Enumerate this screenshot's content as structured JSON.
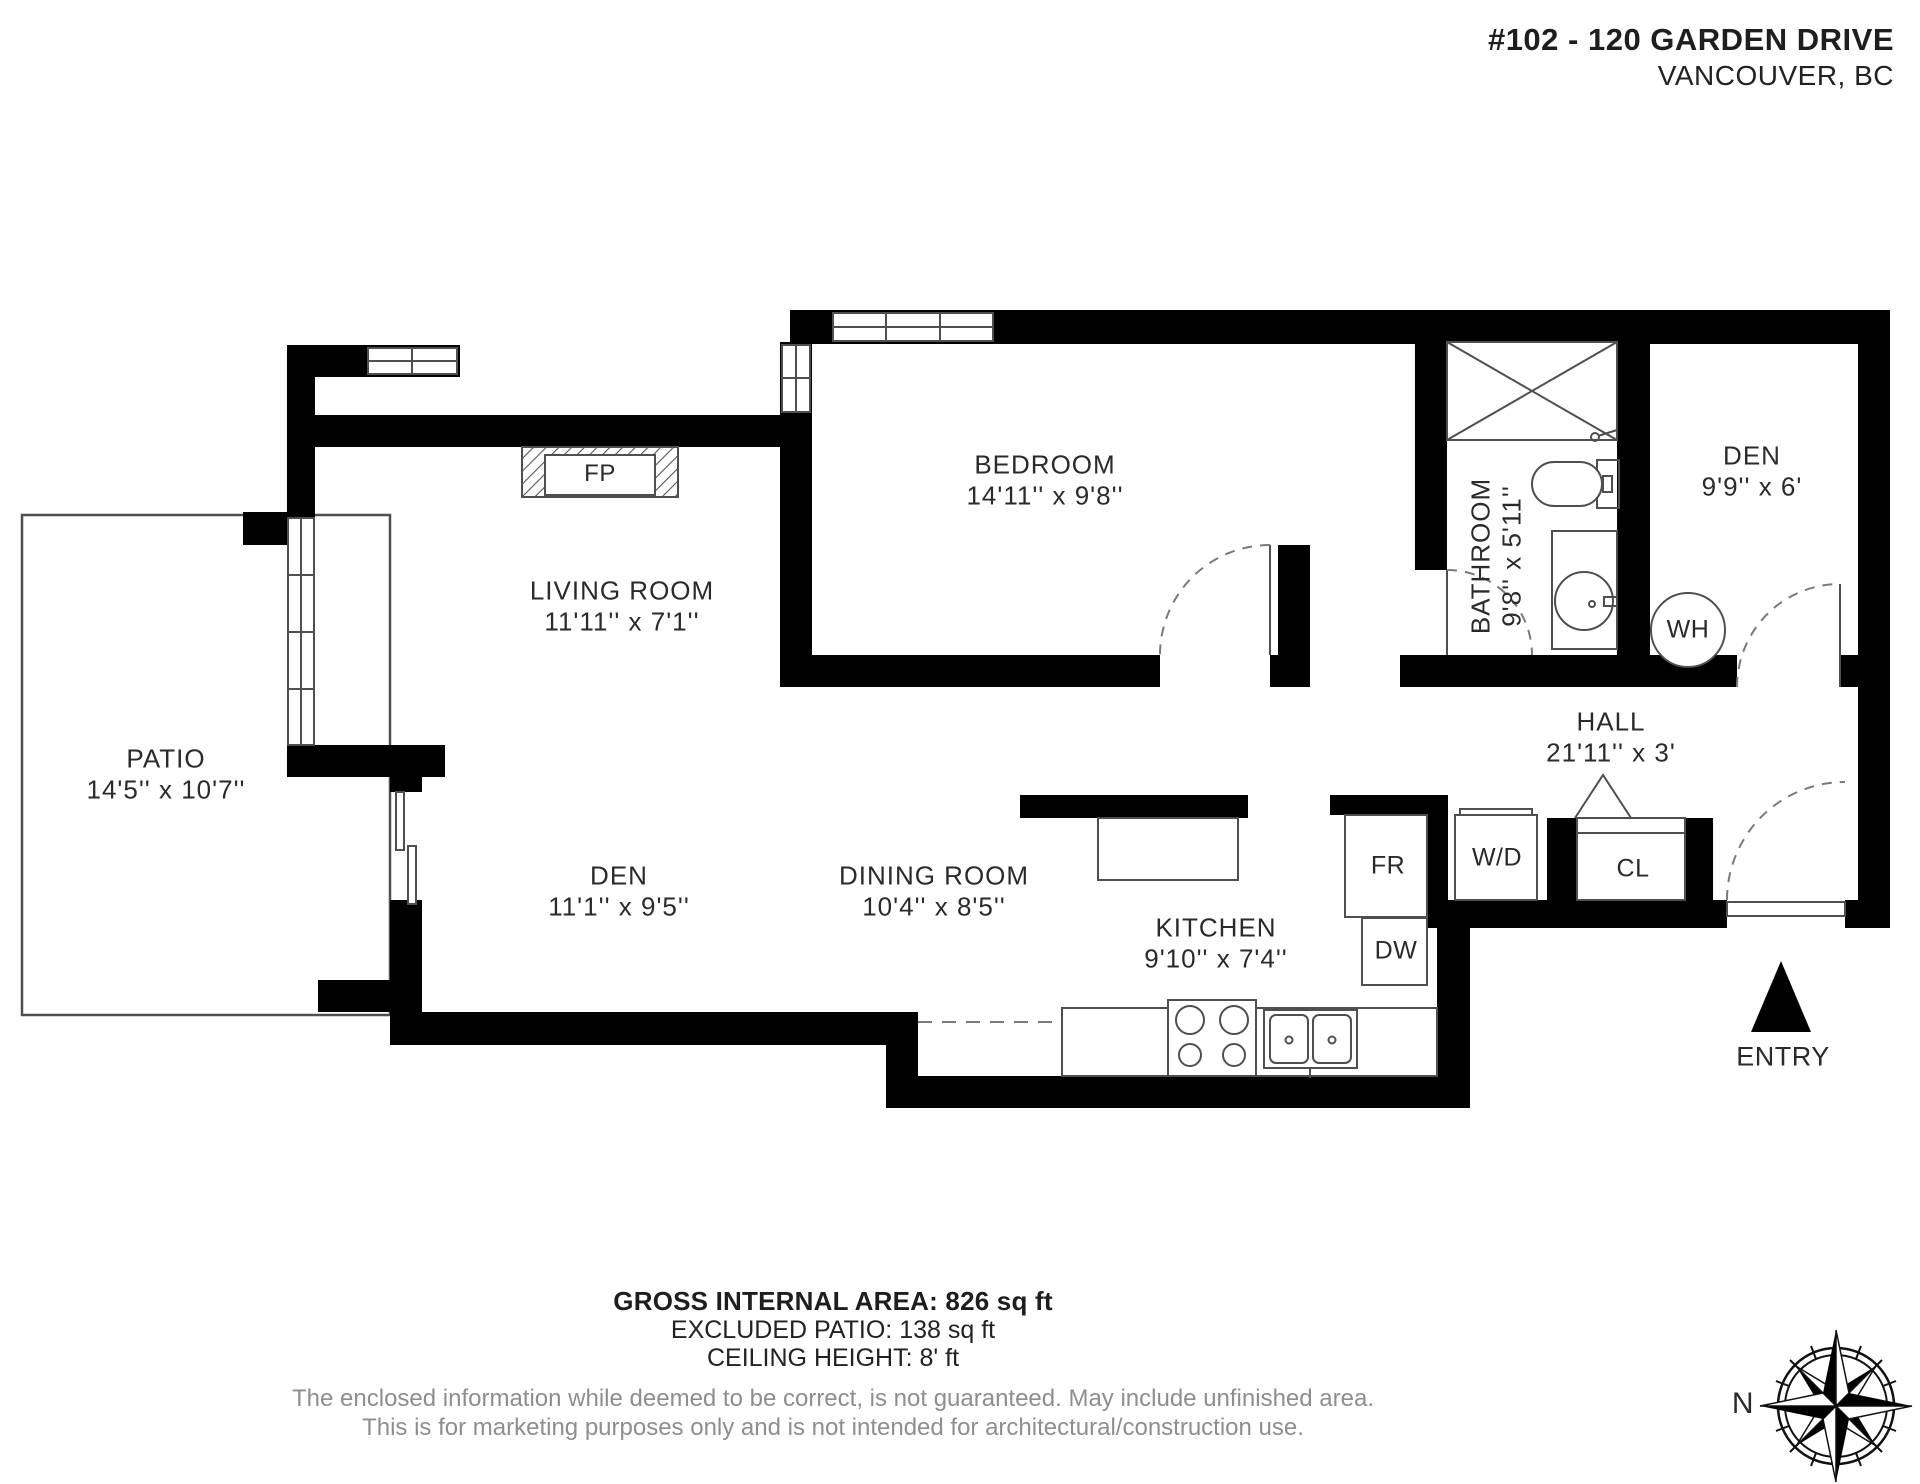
{
  "header": {
    "title": "#102 - 120 GARDEN DRIVE",
    "city": "VANCOUVER, BC"
  },
  "rooms": {
    "patio": {
      "name": "PATIO",
      "dims": "14'5'' x 10'7''"
    },
    "living_room": {
      "name": "LIVING ROOM",
      "dims": "11'11'' x 7'1''"
    },
    "bedroom": {
      "name": "BEDROOM",
      "dims": "14'11'' x 9'8''"
    },
    "bathroom": {
      "name": "BATHROOM",
      "dims": "9'8'' x 5'11''"
    },
    "den_upper": {
      "name": "DEN",
      "dims": "9'9'' x 6'"
    },
    "den_lower": {
      "name": "DEN",
      "dims": "11'1'' x 9'5''"
    },
    "dining_room": {
      "name": "DINING ROOM",
      "dims": "10'4'' x 8'5''"
    },
    "kitchen": {
      "name": "KITCHEN",
      "dims": "9'10'' x 7'4''"
    },
    "hall": {
      "name": "HALL",
      "dims": "21'11'' x 3'"
    }
  },
  "fixtures": {
    "fireplace": "FP",
    "water_heater": "WH",
    "fridge": "FR",
    "dishwasher": "DW",
    "washer_dryer": "W/D",
    "closet": "CL",
    "entry": "ENTRY",
    "compass_north": "N"
  },
  "footer": {
    "gross_area": "GROSS INTERNAL AREA: 826 sq ft",
    "excluded_patio": "EXCLUDED PATIO: 138 sq ft",
    "ceiling_height": "CEILING HEIGHT: 8' ft",
    "disclaimer_line1": "The enclosed information while deemed to be correct, is not guaranteed. May include unfinished area.",
    "disclaimer_line2": "This is for marketing  purposes only and is not intended for architectural/construction use."
  },
  "colors": {
    "wall": "#000000",
    "fixture_line": "#4f4f4f",
    "door_arc": "#7a7a7a",
    "disclaimer_text": "#8e8e8e"
  }
}
